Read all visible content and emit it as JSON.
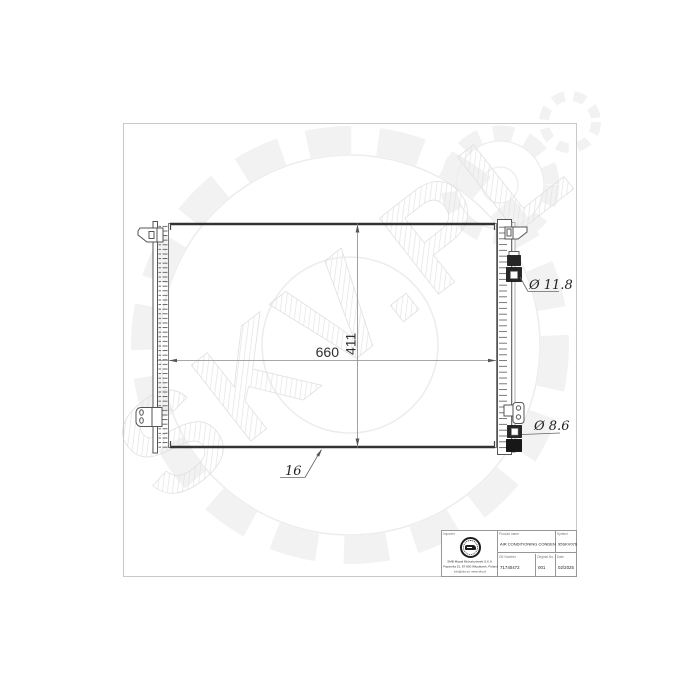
{
  "watermark": {
    "text": "SKV.PL"
  },
  "drawing": {
    "dim_width_label": "660",
    "dim_height_label": "411",
    "thickness_label": "16",
    "upper_port_diameter": "Ø 11.8",
    "lower_port_diameter": "Ø 8.6"
  },
  "title_block": {
    "importer": {
      "label": "Importer",
      "address_line1": "SMB-Migrał Michalczewski S.K.A.",
      "address_line2": "Papieżka 51, 87-800 Włocławek, Poland",
      "address_line3": "info@skv.pl, www.skv.pl"
    },
    "product": {
      "label": "Product name",
      "value": "AIR CONDITIONING CONDENSER"
    },
    "symbol": {
      "label": "Symbol",
      "value": "95SKV076"
    },
    "oe_number": {
      "label": "OE Number",
      "value": "71740472"
    },
    "original_no": {
      "label": "Original No.",
      "value": "001"
    },
    "date": {
      "label": "Date",
      "value": "02/2025"
    }
  }
}
